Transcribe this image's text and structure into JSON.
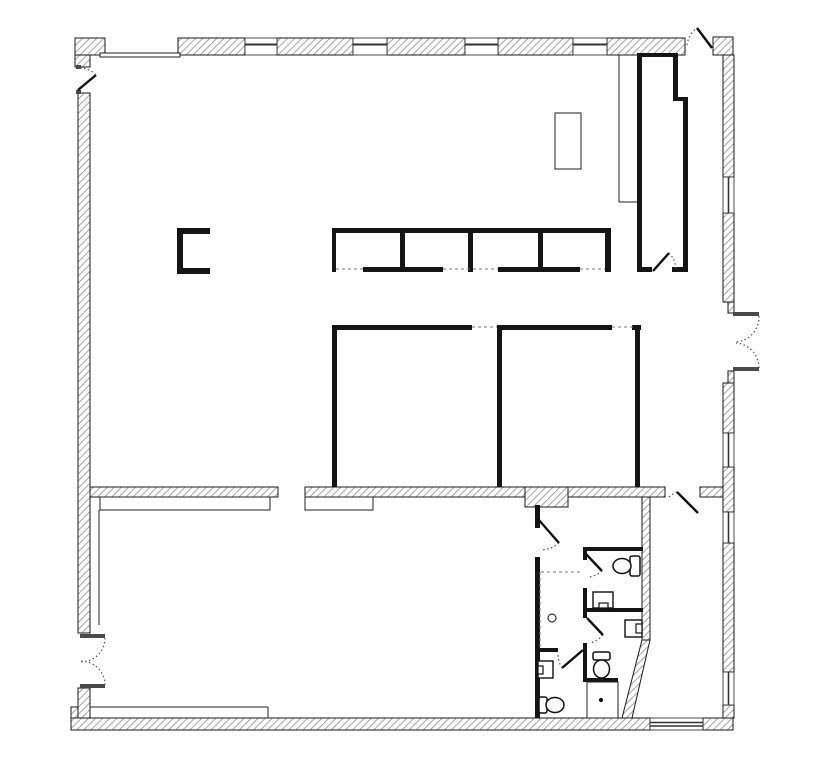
{
  "canvas": {
    "width": 819,
    "height": 768,
    "background": "#ffffff"
  },
  "palette": {
    "exterior_wall_stroke": "#1a1a1a",
    "hatch_line": "#8f8f8f",
    "solid_wall": "#151515",
    "thin_line": "#222222",
    "mullion": "#333333",
    "dash_line": "#777777",
    "door_leaf": "#111111",
    "arc_dot": "#555555",
    "jamb": "#4a4a4a",
    "fixture_stroke": "#111111",
    "white": "#ffffff"
  },
  "plan": {
    "hatched_walls": [
      {
        "n": "column-top-left",
        "r": [
          75,
          38,
          30,
          17
        ]
      },
      {
        "n": "column-top-left-lower",
        "r": [
          75,
          55,
          15,
          12
        ]
      },
      {
        "n": "wall-top-1",
        "r": [
          178,
          38,
          67,
          17
        ]
      },
      {
        "n": "wall-top-2",
        "r": [
          277,
          38,
          76,
          17
        ]
      },
      {
        "n": "wall-top-3",
        "r": [
          387,
          38,
          78,
          17
        ]
      },
      {
        "n": "wall-top-4",
        "r": [
          498,
          38,
          75,
          17
        ]
      },
      {
        "n": "wall-top-5",
        "r": [
          607,
          38,
          78,
          17
        ]
      },
      {
        "n": "column-top-right",
        "r": [
          713,
          37,
          20,
          18
        ]
      },
      {
        "n": "wall-right-1",
        "r": [
          723,
          55,
          11,
          122
        ]
      },
      {
        "n": "wall-right-2",
        "r": [
          723,
          213,
          11,
          89
        ]
      },
      {
        "n": "wall-right-recess-upper",
        "r": [
          728,
          302,
          6,
          11
        ]
      },
      {
        "n": "wall-right-recess-lower",
        "r": [
          728,
          371,
          6,
          12
        ]
      },
      {
        "n": "wall-right-3",
        "r": [
          723,
          383,
          11,
          50
        ]
      },
      {
        "n": "wall-right-4",
        "r": [
          723,
          467,
          11,
          45
        ]
      },
      {
        "n": "wall-right-5",
        "r": [
          723,
          543,
          11,
          129
        ]
      },
      {
        "n": "wall-right-6",
        "r": [
          723,
          705,
          11,
          13
        ]
      },
      {
        "n": "column-bottom-right",
        "r": [
          703,
          718,
          30,
          12
        ]
      },
      {
        "n": "wall-bottom",
        "r": [
          71,
          718,
          579,
          12
        ]
      },
      {
        "n": "column-bottom-left",
        "r": [
          71,
          707,
          19,
          11
        ]
      },
      {
        "n": "wall-left-lower",
        "r": [
          78,
          688,
          12,
          30
        ]
      },
      {
        "n": "wall-left-main",
        "r": [
          78,
          93,
          12,
          540
        ]
      },
      {
        "n": "wall-mid-1",
        "r": [
          90,
          487,
          188,
          10
        ]
      },
      {
        "n": "wall-mid-2",
        "r": [
          305,
          487,
          220,
          10
        ]
      },
      {
        "n": "wall-mid-pier",
        "r": [
          525,
          487,
          43,
          20
        ]
      },
      {
        "n": "wall-mid-3",
        "r": [
          568,
          487,
          97,
          10
        ]
      },
      {
        "n": "wall-mid-4",
        "r": [
          700,
          487,
          23,
          10
        ]
      },
      {
        "n": "wall-restroom-right",
        "r": [
          642,
          497,
          8,
          143
        ]
      }
    ],
    "hatched_polygons": [
      {
        "n": "wall-diagonal",
        "pts": "642,640 650,640 632,718 622,718"
      }
    ],
    "solid_walls": [
      {
        "n": "closet-wall-left",
        "r": [
          637,
          53,
          5,
          219
        ]
      },
      {
        "n": "closet-wall-top",
        "r": [
          637,
          53,
          41,
          4
        ]
      },
      {
        "n": "closet-wall-right-upper",
        "r": [
          673,
          53,
          5,
          44
        ]
      },
      {
        "n": "closet-wall-jog",
        "r": [
          673,
          97,
          15,
          4
        ]
      },
      {
        "n": "closet-wall-right-lower",
        "r": [
          683,
          97,
          5,
          175
        ]
      },
      {
        "n": "closet-wall-bottom-left",
        "r": [
          637,
          267,
          15,
          5
        ]
      },
      {
        "n": "closet-wall-bottom-right",
        "r": [
          672,
          267,
          16,
          5
        ]
      },
      {
        "n": "office1-wall-top",
        "r": [
          332,
          325,
          140,
          5
        ]
      },
      {
        "n": "office1-wall-left",
        "r": [
          332,
          327,
          5,
          160
        ]
      },
      {
        "n": "office2-wall-top",
        "r": [
          497,
          325,
          115,
          5
        ]
      },
      {
        "n": "office2-wall-left",
        "r": [
          497,
          327,
          5,
          160
        ]
      },
      {
        "n": "corridor-wall-cap",
        "r": [
          632,
          325,
          9,
          5
        ]
      },
      {
        "n": "corridor-wall",
        "r": [
          635,
          325,
          5,
          162
        ]
      },
      {
        "n": "restroom-wall-left-upper",
        "r": [
          535,
          505,
          5,
          23
        ]
      },
      {
        "n": "restroom-wall-left-lower",
        "r": [
          535,
          557,
          5,
          161
        ]
      },
      {
        "n": "restroom1-wall-top",
        "r": [
          583,
          547,
          60,
          4
        ]
      },
      {
        "n": "restroom1-wall-left-stub",
        "r": [
          583,
          547,
          4,
          13
        ]
      },
      {
        "n": "restroom-wall-left-mid",
        "r": [
          583,
          588,
          4,
          30
        ]
      },
      {
        "n": "restroom-wall-left-low",
        "r": [
          583,
          643,
          4,
          39
        ]
      },
      {
        "n": "restroom1-wall-bottom",
        "r": [
          583,
          608,
          60,
          4
        ]
      },
      {
        "n": "restroom2-wall-bottom",
        "r": [
          583,
          678,
          35,
          4
        ]
      },
      {
        "n": "restroom3-wall-top",
        "r": [
          537,
          648,
          21,
          4
        ]
      },
      {
        "n": "casework-top",
        "r": [
          332,
          228,
          279,
          5
        ]
      },
      {
        "n": "casework-left-end",
        "r": [
          332,
          228,
          4,
          44
        ]
      },
      {
        "n": "casework-right-end",
        "r": [
          605,
          228,
          6,
          44
        ]
      },
      {
        "n": "casework-divider-1",
        "r": [
          400,
          233,
          5,
          39
        ]
      },
      {
        "n": "casework-divider-2",
        "r": [
          468,
          233,
          5,
          39
        ]
      },
      {
        "n": "casework-divider-3",
        "r": [
          538,
          233,
          5,
          39
        ]
      },
      {
        "n": "casework-bottom-1",
        "r": [
          363,
          267,
          80,
          5
        ]
      },
      {
        "n": "casework-bottom-2",
        "r": [
          498,
          267,
          82,
          5
        ]
      },
      {
        "n": "partition-c-vertical",
        "r": [
          177,
          228,
          6,
          46
        ]
      },
      {
        "n": "partition-c-top",
        "r": [
          177,
          228,
          33,
          6
        ]
      },
      {
        "n": "partition-c-bottom",
        "r": [
          177,
          268,
          33,
          6
        ]
      }
    ],
    "jamb_stubs": [
      {
        "n": "jamb-entry-topleft-upper",
        "r": [
          76,
          65,
          5,
          4
        ]
      },
      {
        "n": "jamb-entry-topleft-lower",
        "r": [
          76,
          90,
          5,
          4
        ]
      },
      {
        "n": "jamb-double-door-left-upper",
        "r": [
          80,
          634,
          25,
          4
        ]
      },
      {
        "n": "jamb-double-door-left-lower",
        "r": [
          80,
          684,
          25,
          4
        ]
      },
      {
        "n": "jamb-double-door-right-upper",
        "r": [
          733,
          312,
          26,
          4
        ]
      },
      {
        "n": "jamb-double-door-right-lower",
        "r": [
          733,
          367,
          26,
          4
        ]
      }
    ],
    "window_panes": [
      {
        "n": "window-top-1",
        "r": [
          245,
          38,
          32,
          17
        ]
      },
      {
        "n": "window-top-2",
        "r": [
          353,
          38,
          34,
          17
        ]
      },
      {
        "n": "window-top-3",
        "r": [
          465,
          38,
          33,
          17
        ]
      },
      {
        "n": "window-top-4",
        "r": [
          573,
          38,
          34,
          17
        ]
      },
      {
        "n": "window-right-1",
        "r": [
          723,
          177,
          11,
          36
        ]
      },
      {
        "n": "window-right-2",
        "r": [
          723,
          433,
          11,
          34
        ]
      },
      {
        "n": "window-right-3",
        "r": [
          723,
          512,
          11,
          31
        ]
      },
      {
        "n": "window-right-4",
        "r": [
          723,
          672,
          11,
          33
        ]
      },
      {
        "n": "window-bottom-1",
        "r": [
          650,
          718,
          53,
          12
        ]
      }
    ],
    "mullion_lines": [
      {
        "n": "mullion-top-1",
        "p": [
          245,
          44.5,
          277,
          44.5
        ],
        "w": 2
      },
      {
        "n": "mullion-top-2",
        "p": [
          353,
          44.5,
          387,
          44.5
        ],
        "w": 2
      },
      {
        "n": "mullion-top-3",
        "p": [
          465,
          44.5,
          498,
          44.5
        ],
        "w": 2
      },
      {
        "n": "mullion-top-4",
        "p": [
          573,
          44.5,
          607,
          44.5
        ],
        "w": 2
      },
      {
        "n": "mullion-right-1",
        "p": [
          728.5,
          177,
          728.5,
          213
        ],
        "w": 1.6
      },
      {
        "n": "mullion-right-2",
        "p": [
          728.5,
          433,
          728.5,
          467
        ],
        "w": 1.6
      },
      {
        "n": "mullion-right-3",
        "p": [
          728.5,
          512,
          728.5,
          543
        ],
        "w": 1.6
      },
      {
        "n": "mullion-right-4",
        "p": [
          728.5,
          672,
          728.5,
          705
        ],
        "w": 1.6
      },
      {
        "n": "mullion-bottom-1a",
        "p": [
          650,
          722.5,
          703,
          722.5
        ],
        "w": 1.4
      },
      {
        "n": "mullion-bottom-1b",
        "p": [
          650,
          726,
          703,
          726
        ],
        "w": 1.4
      }
    ],
    "thin_outlines": [
      {
        "n": "storefront-top-left",
        "r": [
          100,
          53,
          80,
          4
        ]
      },
      {
        "n": "table",
        "r": [
          555,
          113,
          26,
          56
        ]
      },
      {
        "n": "low-wall-left",
        "r": [
          100,
          497,
          170,
          13
        ]
      },
      {
        "n": "low-wall-right",
        "r": [
          305,
          497,
          68,
          13
        ]
      },
      {
        "n": "shower-room",
        "r": [
          587,
          682,
          31,
          36
        ]
      }
    ],
    "thin_lines": [
      {
        "n": "finish-line-left",
        "p": [
          99,
          510,
          99,
          625
        ],
        "w": 1
      },
      {
        "n": "finish-line-bottom",
        "p": [
          90,
          707,
          268,
          707
        ],
        "w": 1
      },
      {
        "n": "finish-line-bottom-return",
        "p": [
          268,
          707,
          268,
          718
        ],
        "w": 1
      },
      {
        "n": "screen-line-vertical",
        "p": [
          619,
          55,
          619,
          202
        ],
        "w": 1
      },
      {
        "n": "screen-line-horizontal",
        "p": [
          619,
          202,
          637,
          202
        ],
        "w": 1
      }
    ],
    "dashed_lines": [
      {
        "n": "opening-office1",
        "p": [
          472,
          327,
          497,
          327
        ]
      },
      {
        "n": "opening-office2",
        "p": [
          612,
          327,
          633,
          327
        ]
      },
      {
        "n": "casework-edge-1",
        "p": [
          336,
          269,
          363,
          269
        ]
      },
      {
        "n": "casework-edge-2",
        "p": [
          443,
          269,
          498,
          269
        ]
      },
      {
        "n": "casework-edge-3",
        "p": [
          580,
          269,
          605,
          269
        ]
      },
      {
        "n": "curtain-horizontal",
        "p": [
          541,
          572,
          583,
          572
        ]
      },
      {
        "n": "curtain-vertical",
        "p": [
          540,
          572,
          540,
          648
        ]
      }
    ],
    "door_leaves": [
      {
        "n": "door-leaf-entry-topleft",
        "p": [
          78,
          90,
          96,
          75
        ]
      },
      {
        "n": "door-leaf-entry-topright",
        "p": [
          697,
          28,
          712,
          48
        ]
      },
      {
        "n": "door-leaf-closet",
        "p": [
          653,
          271,
          669,
          253
        ]
      },
      {
        "n": "door-leaf-storage-room",
        "p": [
          677,
          492,
          698,
          513
        ]
      },
      {
        "n": "door-leaf-corridor",
        "p": [
          538,
          519,
          559,
          543
        ]
      },
      {
        "n": "door-leaf-restroom1",
        "p": [
          585,
          553,
          602,
          571
        ]
      },
      {
        "n": "door-leaf-restroom2",
        "p": [
          587,
          618,
          603,
          635
        ]
      },
      {
        "n": "door-leaf-restroom3",
        "p": [
          583,
          650,
          562,
          668
        ]
      }
    ],
    "door_arcs": [
      {
        "n": "door-arc-entry-topleft",
        "d": "M 80 68 A 22 22 0 0 1 96 75"
      },
      {
        "n": "door-arc-entry-topright",
        "d": "M 687 45 A 25 25 0 0 1 697 28"
      },
      {
        "n": "door-arc-closet",
        "d": "M 669 253 A 24 24 0 0 1 676 268"
      },
      {
        "n": "door-arc-storage-room",
        "d": "M 677 492 A 28 28 0 0 0 668 498"
      },
      {
        "n": "door-arc-corridor",
        "d": "M 559 543 A 29 29 0 0 1 541 550"
      },
      {
        "n": "door-arc-restroom1",
        "d": "M 602 571 A 24 24 0 0 1 589 577"
      },
      {
        "n": "door-arc-restroom2",
        "d": "M 603 635 A 23 23 0 0 1 590 643"
      },
      {
        "n": "door-arc-restroom3",
        "d": "M 562 668 A 27 27 0 0 1 558 655"
      },
      {
        "n": "door-arc-double-left-upper",
        "d": "M 105 638 A 24 24 0 0 1 81 662"
      },
      {
        "n": "door-arc-double-left-lower",
        "d": "M 105 685 A 24 24 0 0 0 81 661"
      },
      {
        "n": "door-arc-double-right-upper",
        "d": "M 759 316 A 25 25 0 0 1 736 342"
      },
      {
        "n": "door-arc-double-right-lower",
        "d": "M 759 368 A 25 25 0 0 0 736 343"
      }
    ],
    "toilets": [
      {
        "n": "toilet-restroom1",
        "bowl": [
          622,
          566,
          9,
          7.5
        ],
        "tank": [
          630,
          556,
          10,
          20
        ]
      },
      {
        "n": "toilet-restroom2",
        "bowl": [
          601.5,
          669,
          8,
          9
        ],
        "tank": [
          593,
          652,
          17,
          8
        ]
      },
      {
        "n": "toilet-restroom3",
        "bowl": [
          555,
          705,
          9,
          7.5
        ],
        "tank": [
          539,
          697,
          8,
          16
        ]
      }
    ],
    "sinks": [
      {
        "n": "sink-restroom1",
        "body": [
          593,
          592,
          20,
          16
        ],
        "faucet": [
          599,
          603,
          9,
          5
        ]
      },
      {
        "n": "sink-restroom2",
        "body": [
          625,
          620,
          17,
          17
        ],
        "faucet": [
          636,
          624,
          6,
          9
        ]
      },
      {
        "n": "sink-restroom3",
        "body": [
          538,
          661,
          15,
          17
        ],
        "faucet": [
          538,
          666,
          5,
          8
        ]
      }
    ],
    "circles": [
      {
        "n": "floor-drain",
        "c": [
          552,
          618,
          4
        ],
        "fill": "none"
      },
      {
        "n": "shower-drain",
        "c": [
          601,
          700,
          1.6
        ],
        "fill": "#111111"
      }
    ]
  }
}
